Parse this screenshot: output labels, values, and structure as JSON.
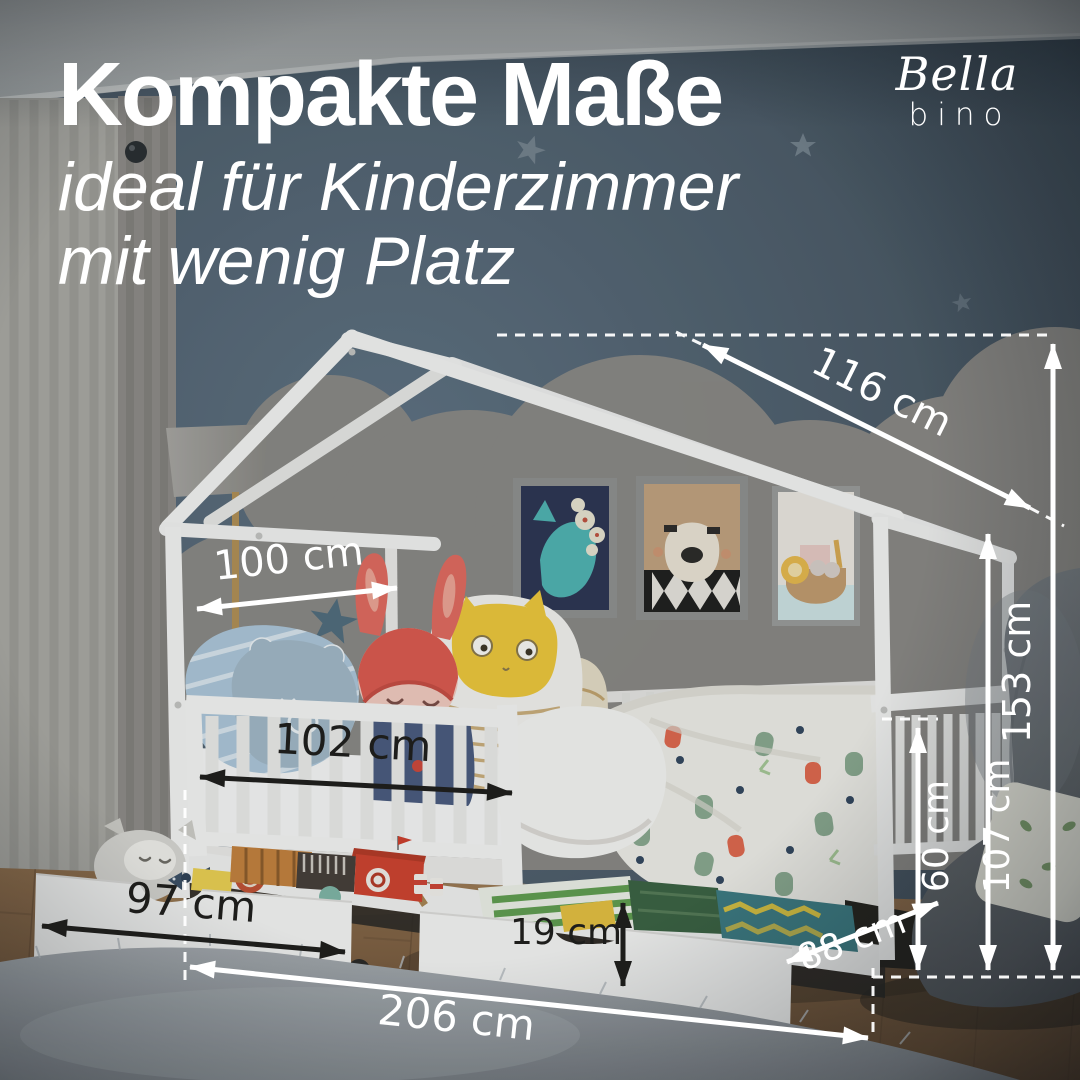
{
  "header": {
    "title": "Kompakte Maße",
    "subtitle_line1": "ideal für Kinderzimmer",
    "subtitle_line2": "mit wenig Platz"
  },
  "brand": {
    "name_top": "Bella",
    "name_bottom": "bino"
  },
  "measurements": {
    "roof_slope": "116 cm",
    "canopy_depth": "100 cm",
    "lying_width": "102 cm",
    "height_total": "153 cm",
    "height_frame": "107 cm",
    "height_rail": "60 cm",
    "drawer_width": "97 cm",
    "drawer_height": "19 cm",
    "bed_depth": "88 cm",
    "total_length": "206 cm"
  },
  "colors": {
    "wall": "#4a5864",
    "bed_white": "#f5f4f2",
    "annotation_light": "#ffffff",
    "annotation_dark": "#1d1d1b",
    "floor_wood": "#7a5a3e"
  },
  "scene_items": {
    "wall_art_1": "whale-picture",
    "wall_art_2": "bear-picture",
    "wall_art_3": "ark-picture",
    "furniture": "house-frame-bed-with-drawers"
  }
}
